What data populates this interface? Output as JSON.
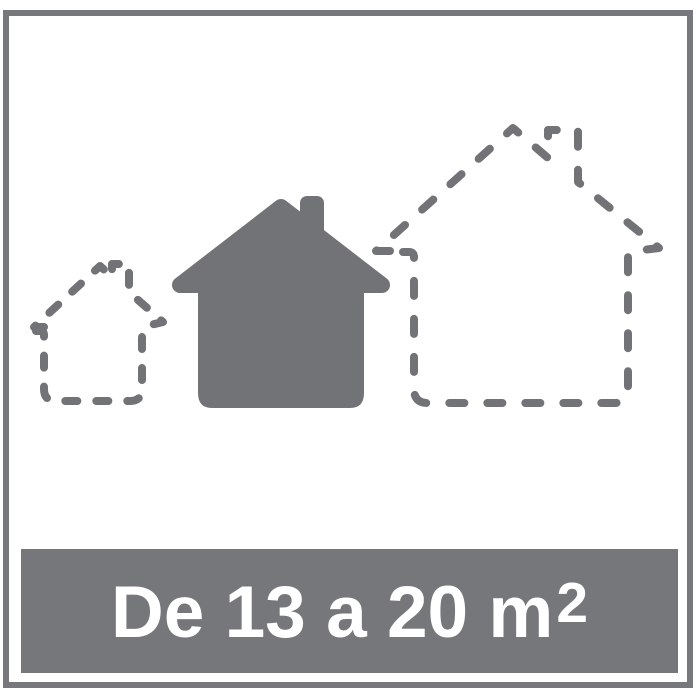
{
  "banner": {
    "text": "De 13 a 20 m²",
    "text_main": "De 13 a 20 m",
    "text_sup": "2"
  },
  "pictogram": {
    "description_visible": "",
    "houses": [
      {
        "name": "small-dashed-house-icon",
        "style": "dashed-outline",
        "size": "small"
      },
      {
        "name": "solid-house-icon",
        "style": "filled",
        "size": "medium"
      },
      {
        "name": "large-dashed-house-icon",
        "style": "dashed-outline",
        "size": "large"
      }
    ]
  },
  "colors": {
    "page_bg": "#FFFFFF",
    "frame_gray": "#76787B",
    "pictogram_gray": "#717377",
    "banner_gray": "#75777A",
    "text_white": "#FFFFFF"
  }
}
